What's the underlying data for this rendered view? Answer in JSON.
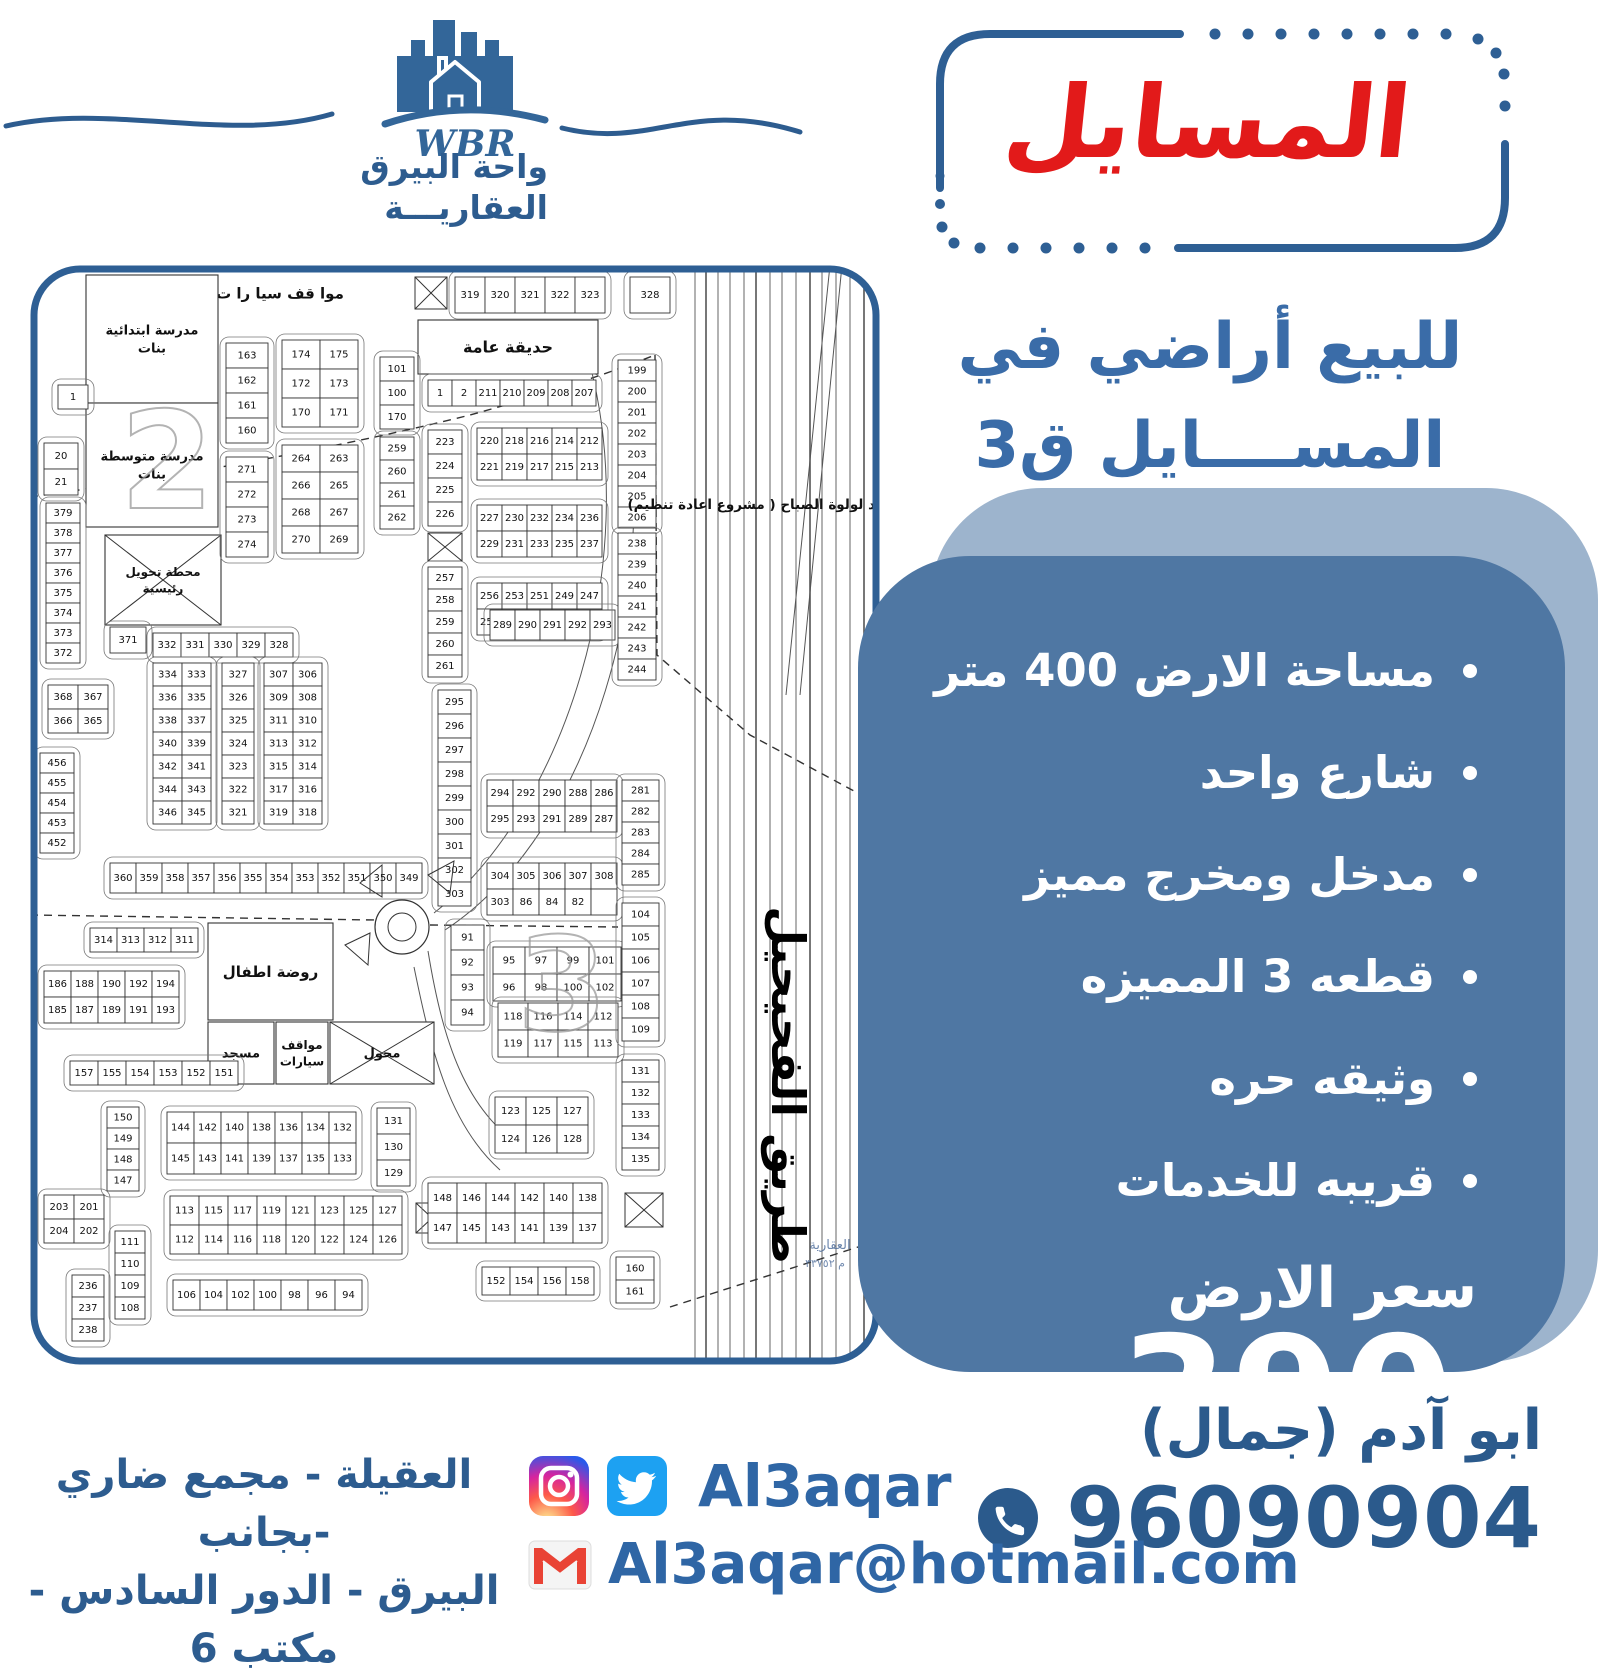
{
  "logo": {
    "monogram": "WBR",
    "name_line1": "واحة البيرق",
    "name_line2": "العقاريـــة"
  },
  "title": {
    "text": "المسايل"
  },
  "subtitle": {
    "line1": "للبيع أراضي في",
    "line2": "المســــايل ق3"
  },
  "features": {
    "items": [
      "مساحة الارض 400 متر",
      "شارع واحد",
      "مدخل ومخرج مميز",
      "قطعه 3 المميزه",
      "وثيقه حره",
      "قريبه للخدمات"
    ],
    "price_label": "سعر الارض",
    "price_value": "390",
    "price_unit": "الف"
  },
  "contact": {
    "name": "ابو آدم (جمال)",
    "phone": "96090904",
    "social_handle": "Al3aqar",
    "email": "Al3aqar@hotmail.com",
    "address_line1": "العقيلة - مجمع ضاري -بجانب",
    "address_line2": "البيرق - الدور السادس - مكتب 6"
  },
  "colors": {
    "primary_blue": "#2d5c8f",
    "accent_blue": "#3a6ca8",
    "panel_blue": "#4f77a3",
    "panel_light": "#9db4cd",
    "title_red": "#e21a1a",
    "map_border": "#2e5f94",
    "twitter_blue": "#1da1f2",
    "gmail_red": "#e94335"
  },
  "map": {
    "road_label": "طريق الفحيحيل",
    "note": "د لولوة الصباح ( مشروع اعادة تنظيم)",
    "corner_faded_line1": "العقارية",
    "corner_faded_line2": "م ٣٣٧٥٢",
    "watermarks": [
      {
        "t": "2",
        "x": 90,
        "y": 243,
        "fs": 135
      },
      {
        "t": "3",
        "x": 487,
        "y": 765,
        "fs": 130
      }
    ],
    "areas": [
      {
        "x": 120,
        "y": 10,
        "w": 260,
        "h": 36,
        "fs": 15,
        "lines": [
          "موا قف سيا را ت"
        ],
        "noRect": true
      },
      {
        "x": 388,
        "y": 55,
        "w": 180,
        "h": 54,
        "fs": 16,
        "lines": [
          "حديقة عامة"
        ]
      },
      {
        "x": 56,
        "y": 10,
        "w": 132,
        "h": 128,
        "fs": 13,
        "lines": [
          "مدرسة ابتدائية",
          "بنات"
        ]
      },
      {
        "x": 56,
        "y": 138,
        "w": 132,
        "h": 124,
        "fs": 13,
        "lines": [
          "مدرسة متوسطة",
          "بنات"
        ]
      },
      {
        "x": 75,
        "y": 270,
        "w": 116,
        "h": 90,
        "fs": 12,
        "lines": [
          "محطة تحويل",
          "رئيسية"
        ],
        "xbox": true
      },
      {
        "x": 178,
        "y": 658,
        "w": 125,
        "h": 97,
        "fs": 15,
        "lines": [
          "روضة اطفال"
        ]
      },
      {
        "x": 178,
        "y": 757,
        "w": 66,
        "h": 62,
        "fs": 13,
        "lines": [
          "مسجد"
        ]
      },
      {
        "x": 246,
        "y": 757,
        "w": 52,
        "h": 62,
        "fs": 12,
        "lines": [
          "مواقف",
          "سيارات"
        ]
      },
      {
        "x": 300,
        "y": 757,
        "w": 104,
        "h": 62,
        "fs": 13,
        "lines": [
          "محول"
        ],
        "xbox": true
      }
    ],
    "xboxes": [
      [
        385,
        12,
        32,
        32
      ],
      [
        398,
        268,
        34,
        28
      ],
      [
        595,
        928,
        38,
        34
      ],
      [
        386,
        938,
        32,
        30
      ]
    ],
    "blocks": [
      [
        425,
        12,
        5,
        1,
        30,
        36,
        [
          "319",
          "320",
          "321",
          "322",
          "323"
        ]
      ],
      [
        600,
        12,
        1,
        1,
        40,
        36,
        [
          "328"
        ]
      ],
      [
        196,
        78,
        1,
        4,
        42,
        25,
        [
          "163",
          "162",
          "161",
          "160"
        ]
      ],
      [
        196,
        192,
        1,
        4,
        42,
        25,
        [
          "271",
          "272",
          "273",
          "274"
        ]
      ],
      [
        252,
        75,
        2,
        3,
        38,
        29,
        [
          "174",
          "175",
          "172",
          "173",
          "170",
          "171"
        ]
      ],
      [
        252,
        180,
        2,
        4,
        38,
        27,
        [
          "264",
          "263",
          "266",
          "265",
          "268",
          "267",
          "270",
          "269"
        ]
      ],
      [
        350,
        92,
        1,
        3,
        34,
        24,
        [
          "101",
          "100",
          "170"
        ]
      ],
      [
        350,
        172,
        1,
        4,
        34,
        23,
        [
          "259",
          "260",
          "261",
          "262"
        ]
      ],
      [
        398,
        115,
        7,
        1,
        24,
        26,
        [
          "1",
          "2",
          "211",
          "210",
          "209",
          "208",
          "207"
        ]
      ],
      [
        398,
        165,
        1,
        4,
        34,
        24,
        [
          "223",
          "224",
          "225",
          "226"
        ]
      ],
      [
        398,
        302,
        1,
        5,
        34,
        22,
        [
          "257",
          "258",
          "259",
          "260",
          "261"
        ]
      ],
      [
        447,
        163,
        5,
        2,
        25,
        26,
        [
          "220",
          "218",
          "216",
          "214",
          "212",
          "221",
          "219",
          "217",
          "215",
          "213"
        ]
      ],
      [
        447,
        240,
        5,
        2,
        25,
        26,
        [
          "227",
          "230",
          "232",
          "234",
          "236",
          "229",
          "231",
          "233",
          "235",
          "237"
        ]
      ],
      [
        447,
        318,
        5,
        2,
        25,
        26,
        [
          "256",
          "253",
          "251",
          "249",
          "247",
          "255",
          "252",
          "250",
          "248",
          "246"
        ]
      ],
      [
        123,
        368,
        5,
        1,
        28,
        24,
        [
          "332",
          "331",
          "330",
          "329",
          "328"
        ]
      ],
      [
        123,
        398,
        2,
        7,
        29,
        23,
        [
          "334",
          "333",
          "336",
          "335",
          "338",
          "337",
          "340",
          "339",
          "342",
          "341",
          "344",
          "343",
          "346",
          "345"
        ]
      ],
      [
        192,
        398,
        1,
        7,
        32,
        23,
        [
          "327",
          "326",
          "325",
          "324",
          "323",
          "322",
          "321"
        ]
      ],
      [
        234,
        398,
        2,
        7,
        29,
        23,
        [
          "307",
          "306",
          "309",
          "308",
          "311",
          "310",
          "313",
          "312",
          "315",
          "314",
          "317",
          "316",
          "319",
          "318"
        ]
      ],
      [
        408,
        425,
        1,
        9,
        33,
        24,
        [
          "295",
          "296",
          "297",
          "298",
          "299",
          "300",
          "301",
          "302",
          "303"
        ]
      ],
      [
        421,
        660,
        1,
        4,
        33,
        25,
        [
          "91",
          "92",
          "93",
          "94"
        ]
      ],
      [
        460,
        345,
        5,
        1,
        25,
        30,
        [
          "289",
          "290",
          "291",
          "292",
          "293"
        ]
      ],
      [
        457,
        515,
        5,
        2,
        26,
        26,
        [
          "294",
          "292",
          "290",
          "288",
          "286",
          "295",
          "293",
          "291",
          "289",
          "287"
        ]
      ],
      [
        457,
        598,
        5,
        2,
        26,
        26,
        [
          "304",
          "305",
          "306",
          "307",
          "308",
          "303",
          "86",
          "84",
          "82",
          ""
        ]
      ],
      [
        463,
        682,
        4,
        2,
        32,
        27,
        [
          "95",
          "97",
          "99",
          "101",
          "96",
          "98",
          "100",
          "102"
        ]
      ],
      [
        468,
        738,
        4,
        2,
        30,
        27,
        [
          "118",
          "116",
          "114",
          "112",
          "119",
          "117",
          "115",
          "113"
        ]
      ],
      [
        588,
        95,
        1,
        8,
        38,
        21,
        [
          "199",
          "200",
          "201",
          "202",
          "203",
          "204",
          "205",
          "206"
        ]
      ],
      [
        588,
        268,
        1,
        7,
        38,
        21,
        [
          "238",
          "239",
          "240",
          "241",
          "242",
          "243",
          "244"
        ]
      ],
      [
        592,
        515,
        1,
        5,
        37,
        21,
        [
          "281",
          "282",
          "283",
          "284",
          "285"
        ]
      ],
      [
        592,
        638,
        1,
        6,
        37,
        23,
        [
          "104",
          "105",
          "106",
          "107",
          "108",
          "109"
        ]
      ],
      [
        592,
        795,
        1,
        5,
        37,
        22,
        [
          "131",
          "132",
          "133",
          "134",
          "135"
        ]
      ],
      [
        586,
        992,
        1,
        2,
        38,
        23,
        [
          "160",
          "161"
        ]
      ],
      [
        28,
        120,
        1,
        1,
        30,
        24,
        [
          "1"
        ]
      ],
      [
        14,
        178,
        1,
        2,
        34,
        26,
        [
          "20",
          "21"
        ]
      ],
      [
        16,
        238,
        1,
        8,
        34,
        20,
        [
          "379",
          "378",
          "377",
          "376",
          "375",
          "374",
          "373",
          "372"
        ]
      ],
      [
        10,
        488,
        1,
        5,
        34,
        20,
        [
          "456",
          "455",
          "454",
          "453",
          "452"
        ]
      ],
      [
        18,
        420,
        2,
        2,
        30,
        24,
        [
          "368",
          "367",
          "366",
          "365"
        ]
      ],
      [
        80,
        362,
        1,
        1,
        36,
        26,
        [
          "371"
        ]
      ],
      [
        80,
        598,
        12,
        1,
        26,
        30,
        [
          "360",
          "359",
          "358",
          "357",
          "356",
          "355",
          "354",
          "353",
          "352",
          "351",
          "350",
          "349"
        ]
      ],
      [
        60,
        663,
        4,
        1,
        27,
        24,
        [
          "314",
          "313",
          "312",
          "311"
        ]
      ],
      [
        14,
        706,
        5,
        2,
        27,
        26,
        [
          "186",
          "188",
          "190",
          "192",
          "194",
          "185",
          "187",
          "189",
          "191",
          "193"
        ]
      ],
      [
        40,
        796,
        6,
        1,
        28,
        24,
        [
          "157",
          "155",
          "154",
          "153",
          "152",
          "151"
        ]
      ],
      [
        77,
        842,
        1,
        4,
        32,
        21,
        [
          "150",
          "149",
          "148",
          "147"
        ]
      ],
      [
        85,
        966,
        1,
        4,
        30,
        22,
        [
          "111",
          "110",
          "109",
          "108"
        ]
      ],
      [
        14,
        930,
        2,
        2,
        30,
        24,
        [
          "203",
          "201",
          "204",
          "202"
        ]
      ],
      [
        42,
        1010,
        1,
        3,
        32,
        22,
        [
          "236",
          "237",
          "238"
        ]
      ],
      [
        137,
        847,
        7,
        2,
        27,
        31,
        [
          "144",
          "142",
          "140",
          "138",
          "136",
          "134",
          "132",
          "145",
          "143",
          "141",
          "139",
          "137",
          "135",
          "133"
        ]
      ],
      [
        347,
        843,
        1,
        3,
        33,
        26,
        [
          "131",
          "130",
          "129"
        ]
      ],
      [
        140,
        931,
        8,
        2,
        29,
        29,
        [
          "113",
          "115",
          "117",
          "119",
          "121",
          "123",
          "125",
          "127",
          "112",
          "114",
          "116",
          "118",
          "120",
          "122",
          "124",
          "126"
        ]
      ],
      [
        143,
        1015,
        7,
        1,
        27,
        30,
        [
          "106",
          "104",
          "102",
          "100",
          "98",
          "96",
          "94"
        ]
      ],
      [
        465,
        832,
        3,
        2,
        31,
        28,
        [
          "123",
          "125",
          "127",
          "124",
          "126",
          "128"
        ]
      ],
      [
        398,
        918,
        6,
        2,
        29,
        30,
        [
          "148",
          "146",
          "144",
          "142",
          "140",
          "138",
          "147",
          "145",
          "143",
          "141",
          "139",
          "137"
        ]
      ],
      [
        452,
        1002,
        4,
        1,
        28,
        28,
        [
          "152",
          "154",
          "156",
          "158"
        ]
      ]
    ],
    "highway_xs": [
      665,
      676,
      688,
      700,
      714,
      726,
      740,
      752,
      766,
      780,
      792,
      806,
      820,
      834,
      846
    ],
    "highway_slants": [
      "M 800 0 L 756 430",
      "M 812 0 L 770 430"
    ],
    "dashed": [
      "M 0 232 C 160 210 320 180 440 150 C 520 128 580 108 625 90",
      "M 625 90 L 627 390 L 720 470 L 850 540",
      "M 0 650 L 345 655",
      "M 400 660 L 588 662",
      "M 640 1042 L 850 975"
    ],
    "curves": [
      "M 560 100 C 612 300 535 545 404 648",
      "M 588 100 C 640 310 560 570 415 665",
      "M 398 686 C 415 790 440 850 500 888",
      "M 384 702 C 402 790 420 860 470 905"
    ],
    "roundabout": {
      "cx": 372,
      "cy": 662,
      "r1": 27,
      "r2": 14
    }
  }
}
